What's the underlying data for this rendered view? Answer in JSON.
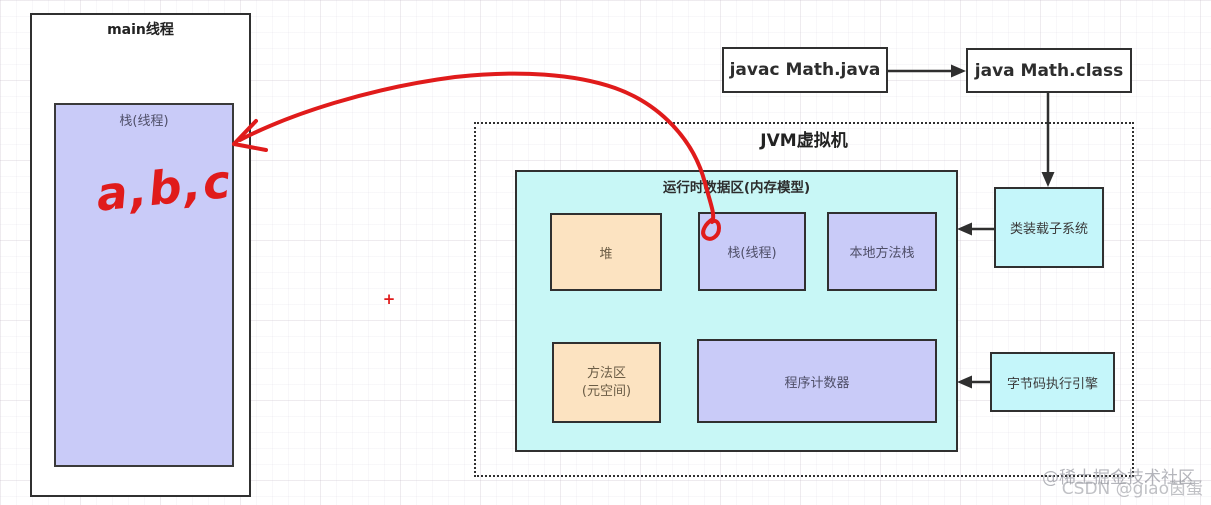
{
  "main_thread": {
    "title": "main线程",
    "stack_label": "栈(线程)",
    "handwriting": "a,b,c"
  },
  "top_flow": {
    "source_box": "javac Math.java",
    "target_box": "java Math.class"
  },
  "jvm": {
    "title": "JVM虚拟机",
    "runtime_area": {
      "title": "运行时数据区(内存模型)",
      "heap": "堆",
      "stack": "栈(线程)",
      "native_stack": "本地方法栈",
      "method_area": "方法区\n(元空间)",
      "pc_register": "程序计数器"
    },
    "class_loader": "类装载子系统",
    "execution_engine": "字节码执行引擎"
  },
  "annotations": {
    "plus_mark": "+"
  },
  "watermark": {
    "line1": "@稀土掘金技术社区",
    "line2": "CSDN @giao茵蛋"
  },
  "colors": {
    "ink_red": "#e01b1b",
    "purple_fill": "#c9cbf8",
    "orange_fill": "#fce3c1",
    "cyan_fill": "#c8f7f6",
    "side_cyan_fill": "#c5f6fa",
    "border": "#303030"
  }
}
